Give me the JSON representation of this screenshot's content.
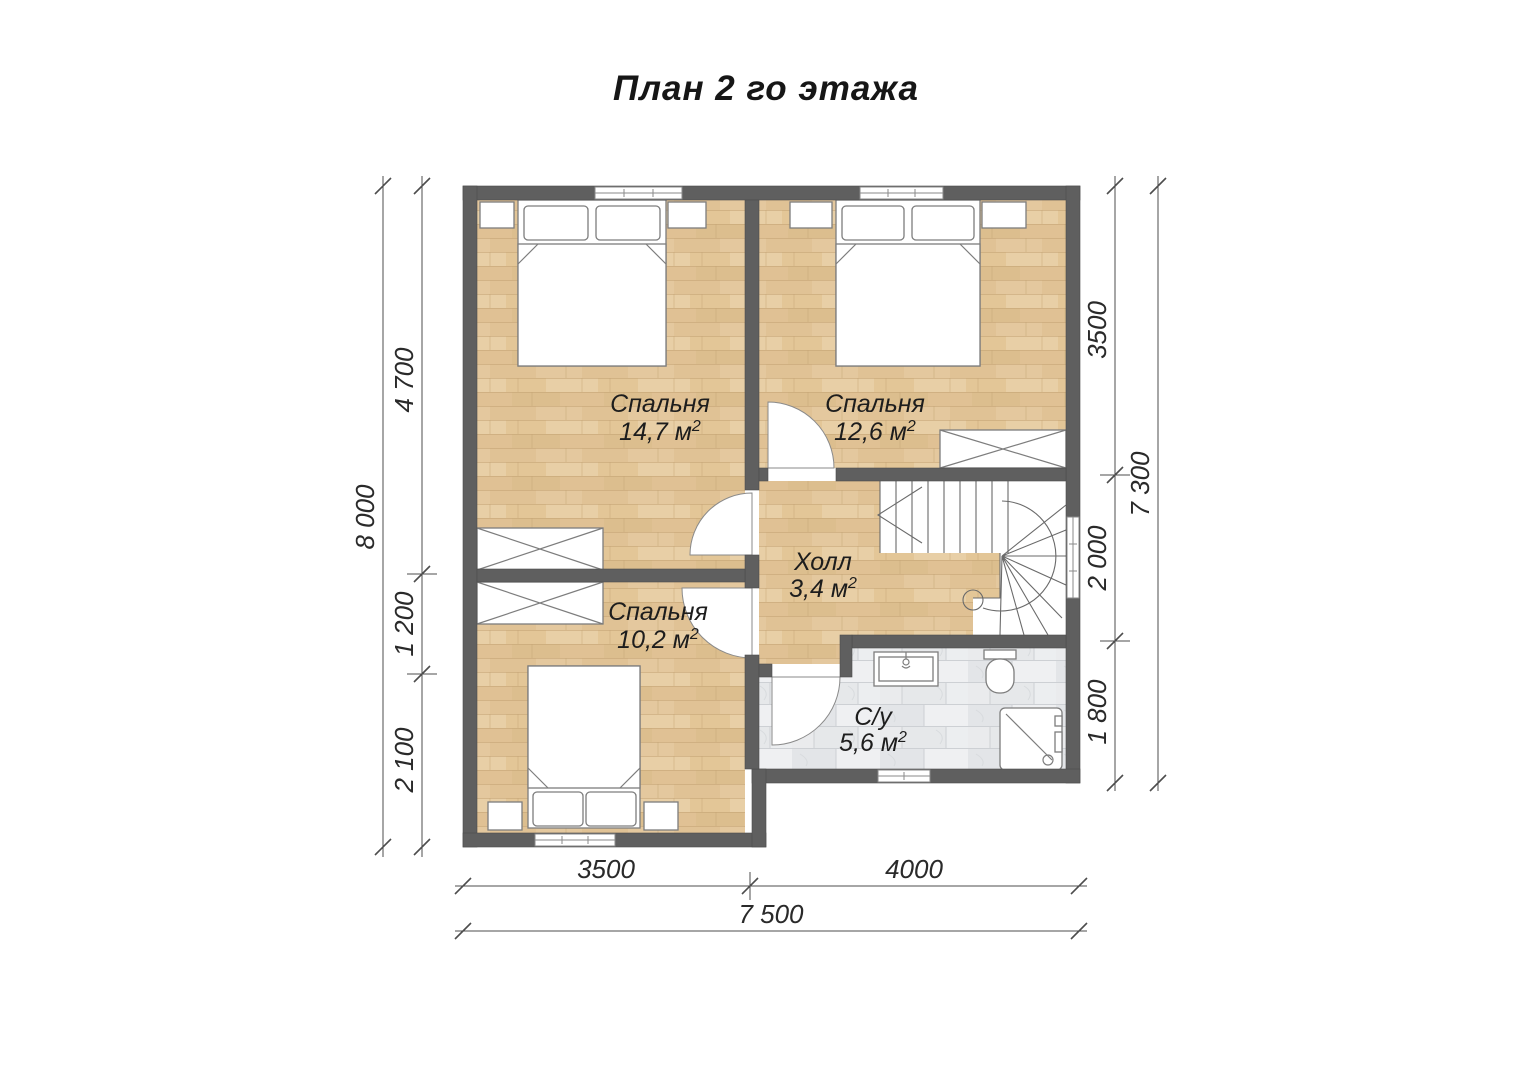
{
  "title": "План 2 го этажа",
  "rooms": [
    {
      "id": "bedroom-1",
      "name": "Спальня",
      "area": "14,7 м",
      "sup": "2"
    },
    {
      "id": "bedroom-2",
      "name": "Спальня",
      "area": "12,6 м",
      "sup": "2"
    },
    {
      "id": "bedroom-3",
      "name": "Спальня",
      "area": "10,2 м",
      "sup": "2"
    },
    {
      "id": "hall",
      "name": "Холл",
      "area": "3,4 м",
      "sup": "2"
    },
    {
      "id": "bathroom",
      "name": "С/у",
      "area": "5,6 м",
      "sup": "2"
    }
  ],
  "dimensions": {
    "left_total": "8 000",
    "left_segments": [
      "4 700",
      "1 200",
      "2 100"
    ],
    "right_segments": [
      "3500",
      "2 000",
      "1 800"
    ],
    "right_total": "7 300",
    "bottom_segments": [
      "3500",
      "4000"
    ],
    "bottom_total": "7 500"
  },
  "colors": {
    "wall": "#5f5f5f",
    "wood": "#e3c69b",
    "marble": "#eaebed",
    "dimension_line": "#4d4d4d"
  }
}
